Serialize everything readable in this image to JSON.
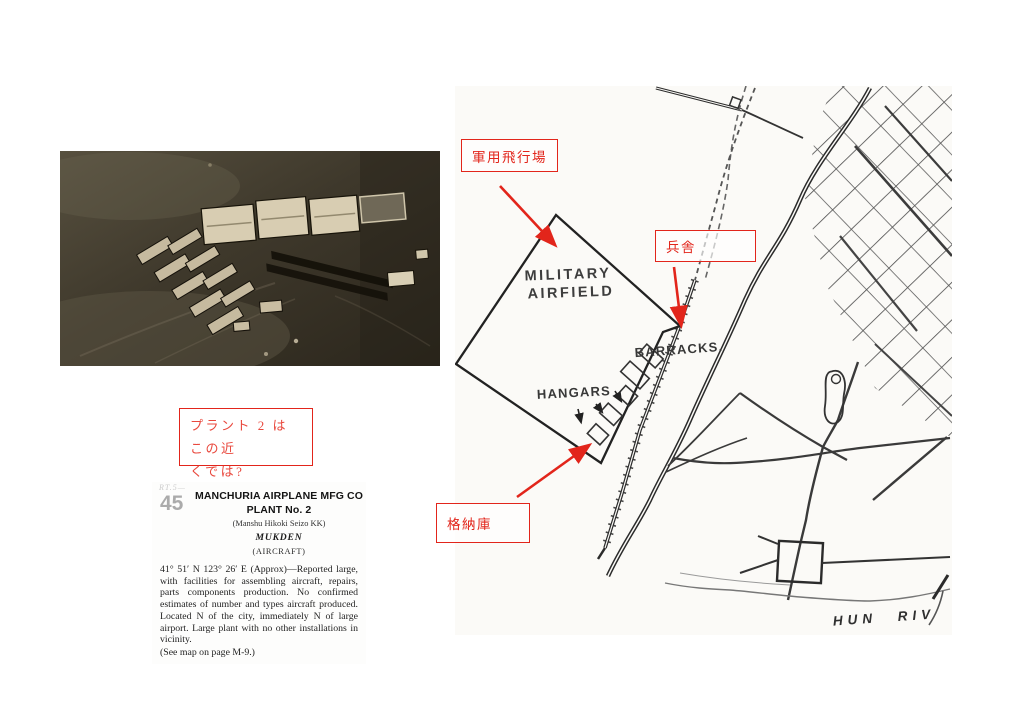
{
  "colors": {
    "annotation_red": "#e2251b",
    "map_ink": "#2b2b2b",
    "page_bg": "#ffffff"
  },
  "photo": {
    "description": "aerial photograph of Manchuria Airplane Mfg Co plant"
  },
  "map": {
    "labels": {
      "military1": "MILITARY",
      "military2": "AIRFIELD",
      "barracks": "BARRACKS.",
      "hangars": "HANGARS",
      "river": "HUN RIV"
    }
  },
  "annotations": {
    "airfield_label": "軍用飛行場",
    "barracks_label": "兵舎",
    "hangar_label": "格納庫",
    "note_line1": "プラント 2 はこの近",
    "note_line2": "くでは?"
  },
  "clipping": {
    "ref_faint": "RT.5—",
    "item_number": "45",
    "title_line1": "MANCHURIA AIRPLANE MFG CO",
    "title_line2": "PLANT No. 2",
    "subtitle": "(Manshu Hikoki Seizo KK)",
    "location": "MUKDEN",
    "category": "(AIRCRAFT)",
    "body": "41° 51′ N 123° 26′ E (Approx)—Reported large, with facilities for assembling aircraft, repairs, parts components production. No confirmed estimates of number and types aircraft produced. Located N of the city, immediately N of large airport. Large plant with no other installations in vicinity.",
    "footnote": "(See map on page M-9.)"
  }
}
